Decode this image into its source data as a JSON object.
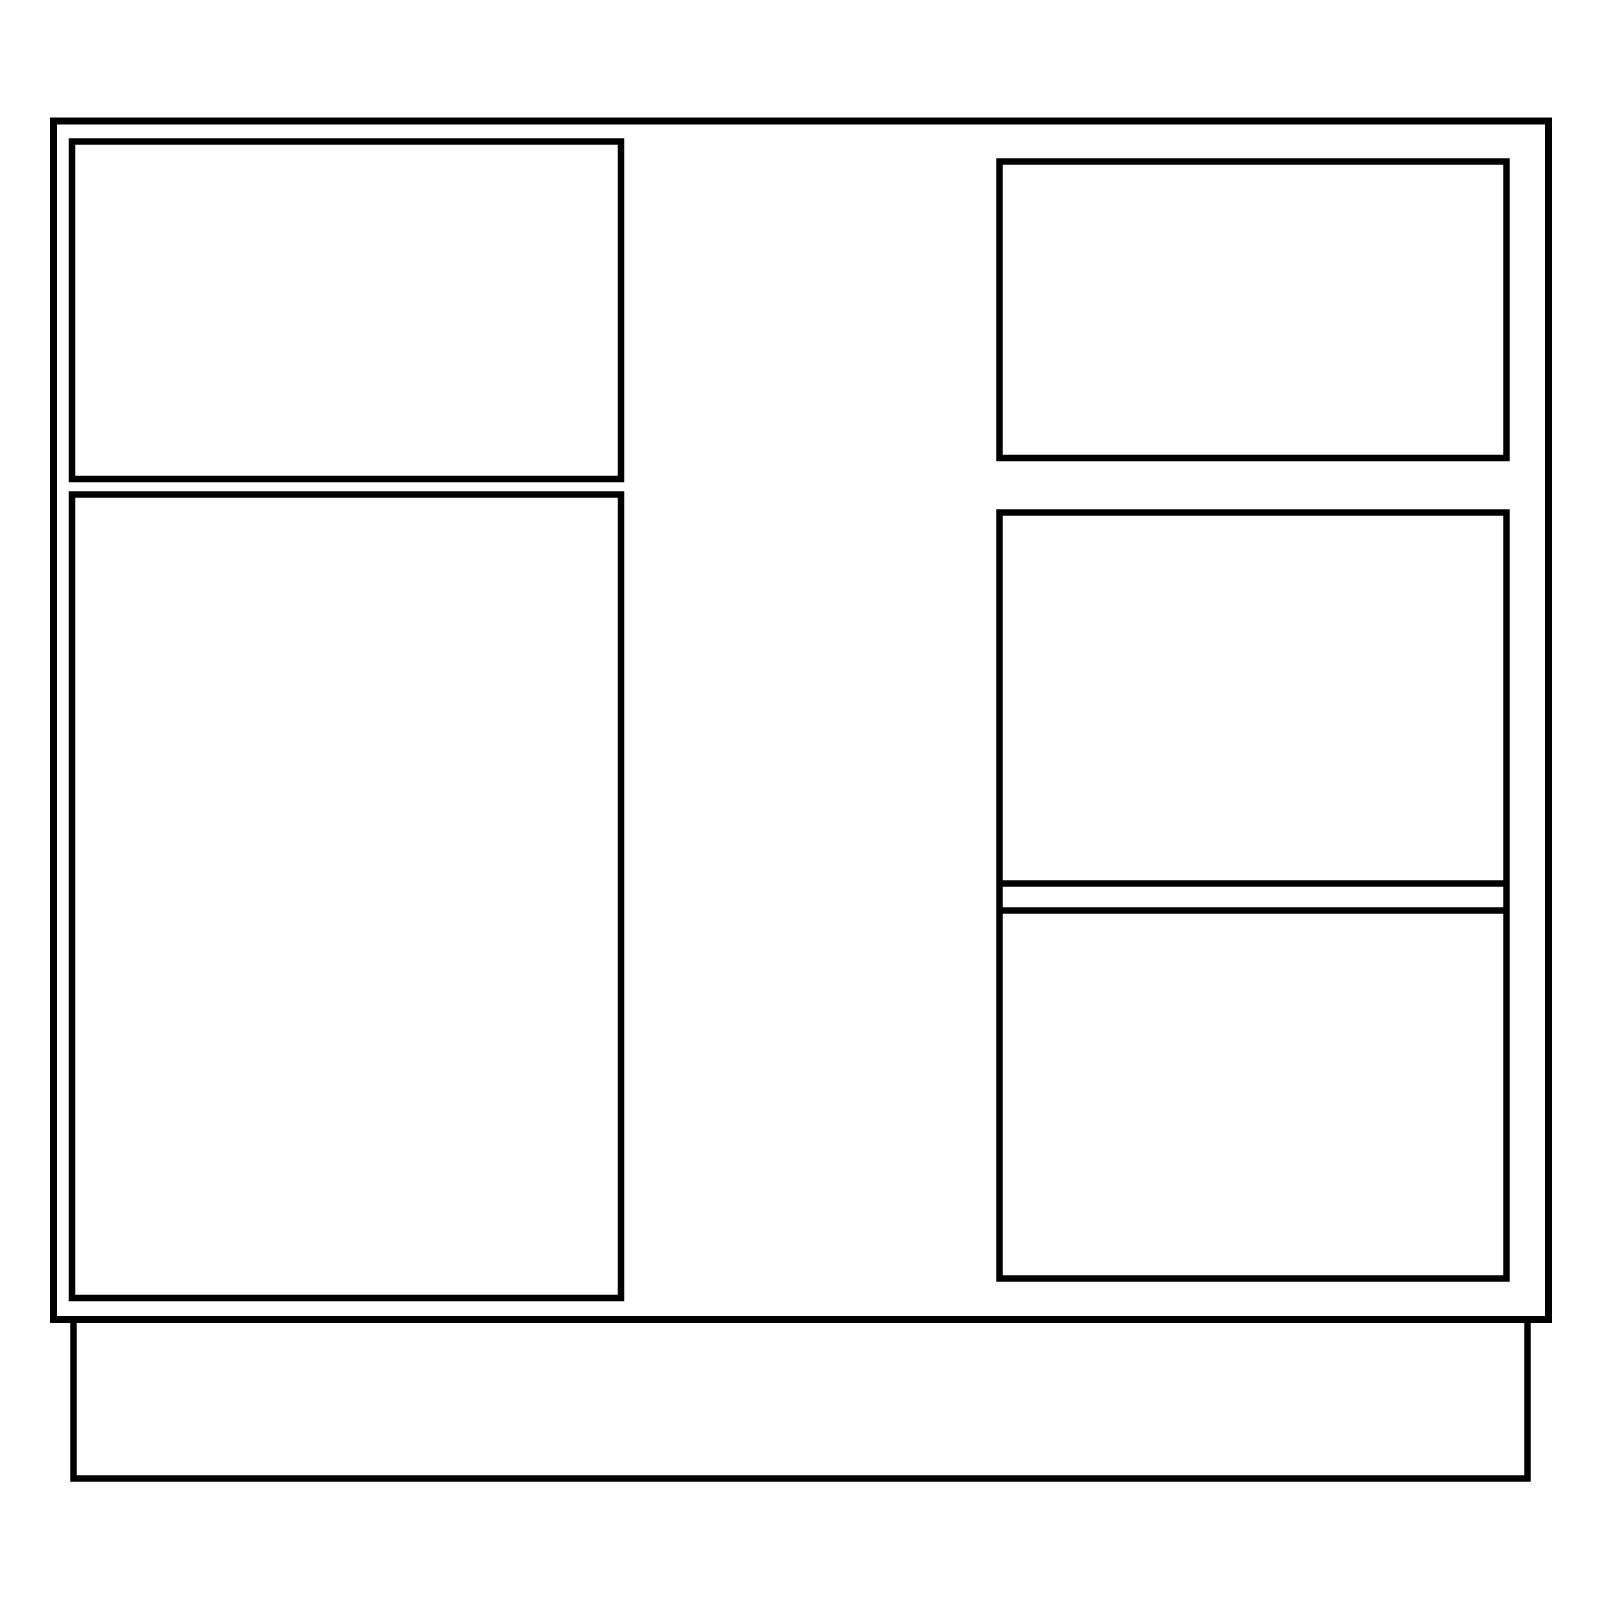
{
  "canvas": {
    "width": 1600,
    "height": 1600,
    "background_color": "#ffffff",
    "stroke_color": "#000000"
  },
  "drawing": {
    "name": "cabinet-elevation",
    "shapes": [
      {
        "name": "cabinet-body-outline",
        "type": "rect",
        "x": 53.5,
        "y": 121,
        "width": 1495,
        "height": 1198.5,
        "stroke_width": 7
      },
      {
        "name": "left-drawer-front",
        "type": "rect",
        "x": 72,
        "y": 141.5,
        "width": 549,
        "height": 337.5,
        "stroke_width": 6.5
      },
      {
        "name": "left-door-panel",
        "type": "rect",
        "x": 72,
        "y": 494.5,
        "width": 549,
        "height": 803.5,
        "stroke_width": 6.5
      },
      {
        "name": "right-drawer-front",
        "type": "rect",
        "x": 999.5,
        "y": 161.5,
        "width": 507,
        "height": 296.5,
        "stroke_width": 6.5
      },
      {
        "name": "right-lower-panel",
        "type": "rect",
        "x": 999.5,
        "y": 512.5,
        "width": 507,
        "height": 766,
        "stroke_width": 6.5
      },
      {
        "name": "right-panel-divider-upper-line",
        "type": "line",
        "x1": 999.5,
        "y1": 883.5,
        "x2": 1506.5,
        "y2": 883.5,
        "stroke_width": 6.5
      },
      {
        "name": "right-panel-divider-lower-line",
        "type": "line",
        "x1": 999.5,
        "y1": 910.5,
        "x2": 1506.5,
        "y2": 910.5,
        "stroke_width": 6.5
      },
      {
        "name": "plinth-base",
        "type": "rect",
        "x": 73.5,
        "y": 1319.5,
        "width": 1454,
        "height": 159,
        "stroke_width": 6.5
      }
    ]
  }
}
